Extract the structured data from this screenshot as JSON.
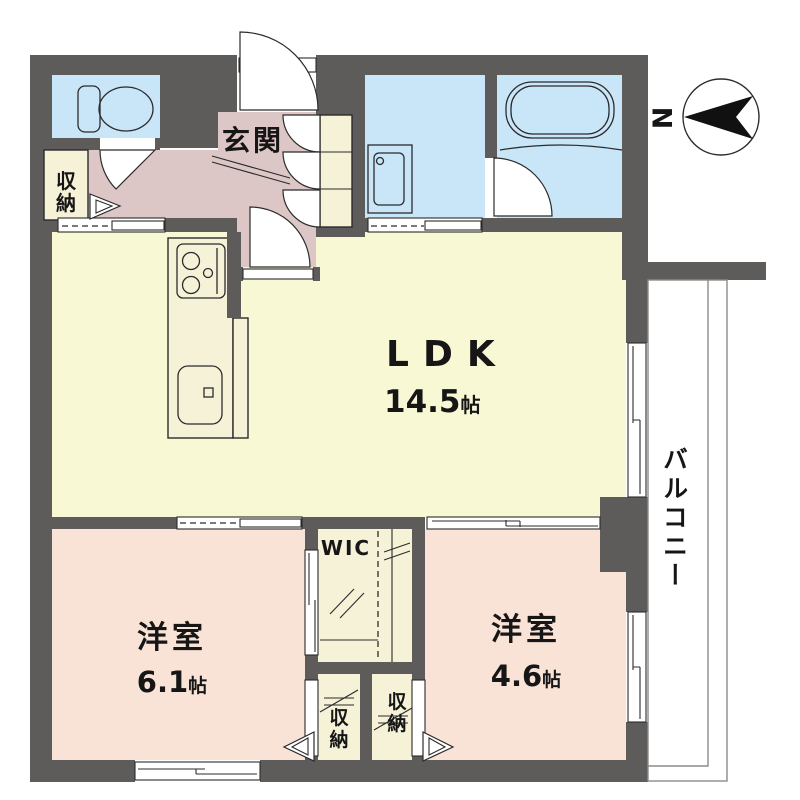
{
  "title": "1LDK+WIC apartment floor plan",
  "compass": {
    "north_label": "N"
  },
  "rooms": {
    "ldk": {
      "label": "LDK",
      "size_value": "14.5",
      "size_unit": "帖"
    },
    "bedroom_left": {
      "label": "洋室",
      "size_value": "6.1",
      "size_unit": "帖"
    },
    "bedroom_right": {
      "label": "洋室",
      "size_value": "4.6",
      "size_unit": "帖"
    },
    "entrance": {
      "label": "玄関"
    },
    "wic": {
      "label": "WIC"
    },
    "balcony": {
      "label": "バルコニー"
    },
    "hall_closet": {
      "chars": [
        "収",
        "納"
      ]
    },
    "closet_left": {
      "chars": [
        "収",
        "納"
      ]
    },
    "closet_right": {
      "chars": [
        "収",
        "納"
      ]
    }
  },
  "fixtures": {
    "toilet": "toilet-icon",
    "bathtub": "bathtub-icon",
    "vanity": "washbasin-icon",
    "stove": "stove-icon",
    "sink": "kitchen-sink-icon"
  },
  "colors": {
    "wall": "#5e5b5b",
    "wet_room_blue": "#c9e5f8",
    "hall_mauve": "#dcc7c6",
    "ldk_yellow": "#f9f8d4",
    "bedroom_pink": "#f9e2d6",
    "closet_cream": "#f6f2d8",
    "line": "#2b2b2b",
    "balcony_line": "#8b8b8b"
  }
}
